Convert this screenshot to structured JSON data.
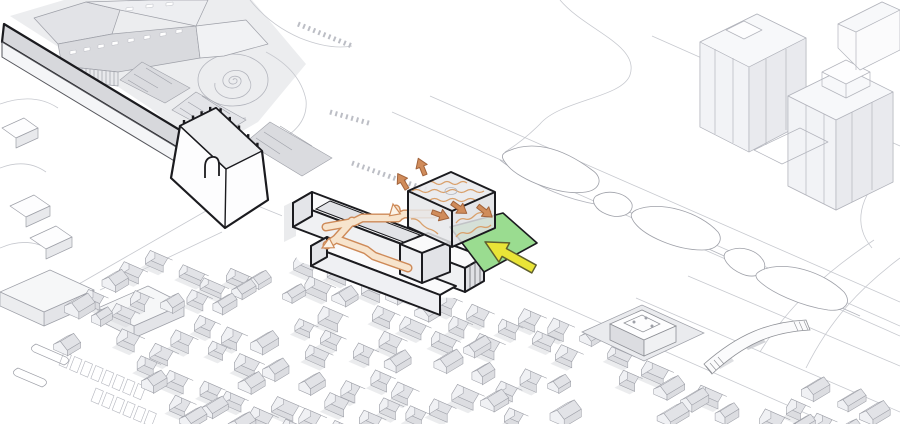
{
  "page": {
    "title": "Axonometric urban design site diagram",
    "type": "architectural-axonometric-diagram",
    "description": "Isometric site drawing: a proposed linear building with a translucent rooftop ventilation box (wavy heat lines, orange exhaust arrows), an orange public circulation route threading the slabs, and a green entry plaza marked by a large yellow approach arrow; context includes a historic city wall with gate tower, a museum with spiral plaza, residential towers, a linear greenway of organic lawns, dense pitched-roof village fabric, surface parking and a pedestrian footbridge."
  },
  "colors": {
    "background": "#FFFFFF",
    "line_faint": "#C7C9CF",
    "line_light": "#B3B5BD",
    "line_mid": "#9EA0A8",
    "line_strong": "#8E9096",
    "line_dark": "#1B1B1F",
    "fill_white": "#FDFDFE",
    "fill_light": "#F0F1F4",
    "fill_shade": "#E2E3E7",
    "fill_wall": "#DCDDE1",
    "fill_dark": "#D2D3D7",
    "shadow": "#D8D9DE",
    "glass": "#E9EAED",
    "plaza_green": "#9ADC90",
    "arrow_yellow": "#E9E437",
    "arrow_yellow_stroke": "#5F5F2E",
    "path_fill": "#F7E4CD",
    "path_stroke": "#CE8A58",
    "path_head_fill": "#FBF3E8",
    "arrow_orange": "#D08C5B",
    "arrow_orange_stroke": "#A2633B",
    "wave_orange": "#D9A06B"
  },
  "scene": {
    "proposed_building": "linear slab building with internal street and end tower",
    "ventilation_box": "translucent rooftop box with heat-wave lines and exhaust arrows",
    "circulation_path": "orange pedestrian route threading through the building",
    "entry_plaza": "green entry plaza",
    "entry_arrow": "yellow main-approach arrow",
    "city_wall": "historic city wall",
    "gate_tower": "gate tower with arched opening and crenellations",
    "museum": "public museum building beside the wall",
    "spiral_plaza": "spiral landscape plaza",
    "residential_towers": "high-rise residential towers",
    "greenway": "linear park with organic lawn islands",
    "urban_village": "dense low-rise pitched-roof fabric",
    "parking": "surface parking lot with stalls",
    "courtyard_complex": "courtyard building cluster",
    "footbridge": "pedestrian bridge over road"
  }
}
